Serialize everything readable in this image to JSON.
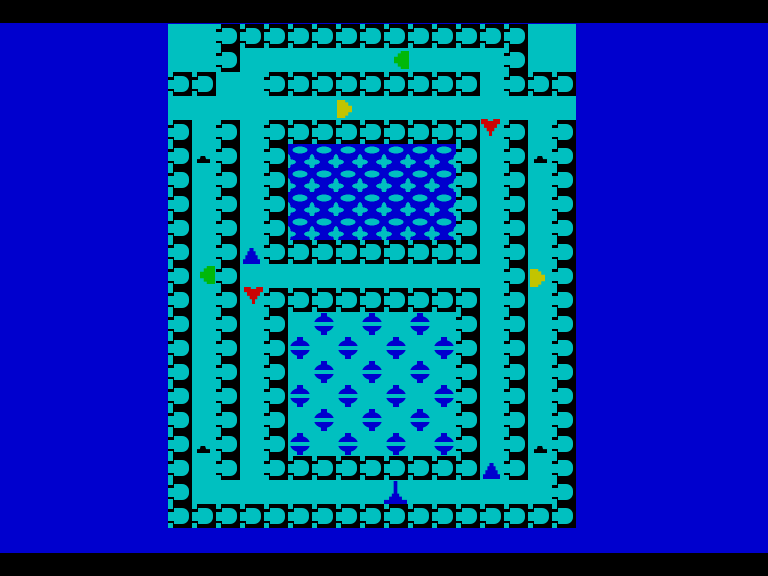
{
  "screen": {
    "width": 768,
    "height": 576
  },
  "colors": {
    "blue": "#0000CE",
    "cyan": "#00C0C0",
    "black": "#000000",
    "green": "#00B80A",
    "yellow": "#C2C400",
    "red": "#CC0404"
  },
  "letterbox": {
    "top_height": 23,
    "bottom_height": 23,
    "bottom_top": 553
  },
  "board": {
    "origin_x": 168,
    "origin_y": 24,
    "cell": 24,
    "cols": 17,
    "rows": 21,
    "first_col": 7,
    "first_row": 1,
    "legend": {
      "#": "wall-block",
      ".": "open-corridor",
      "w": "water",
      "o": "orchard"
    },
    "rows_map": [
      "..#############..",
      "..#...........#..",
      "##..#########.###",
      ".................",
      "#.#.#########.#.#",
      "#.#.#wwwwwww#.#.#",
      "#.#.#wwwwwww#.#.#",
      "#.#.#wwwwwww#.#.#",
      "#.#.#wwwwwww#.#.#",
      "#.#.#########.#.#",
      "#.#...........#.#",
      "#.#.#########.#.#",
      "#.#.#ooooooo#.#.#",
      "#.#.#ooooooo#.#.#",
      "#.#.#ooooooo#.#.#",
      "#.#.#ooooooo#.#.#",
      "#.#.#ooooooo#.#.#",
      "#.#.#ooooooo#.#.#",
      "#.#.#########.#.#",
      "#...............#",
      "#################"
    ]
  },
  "water_area": {
    "col": 12,
    "row": 6,
    "cols": 7,
    "rows": 4
  },
  "orbs": {
    "positions": [
      [
        13,
        13
      ],
      [
        15,
        13
      ],
      [
        17,
        13
      ],
      [
        12,
        14
      ],
      [
        14,
        14
      ],
      [
        16,
        14
      ],
      [
        18,
        14
      ],
      [
        13,
        15
      ],
      [
        15,
        15
      ],
      [
        17,
        15
      ],
      [
        12,
        16
      ],
      [
        14,
        16
      ],
      [
        16,
        16
      ],
      [
        18,
        16
      ],
      [
        13,
        17
      ],
      [
        15,
        17
      ],
      [
        17,
        17
      ],
      [
        12,
        18
      ],
      [
        14,
        18
      ],
      [
        16,
        18
      ],
      [
        18,
        18
      ]
    ]
  },
  "items": [
    {
      "id": "item-green-1",
      "type": "green",
      "x": 394,
      "y": 51
    },
    {
      "id": "item-yellow-1",
      "type": "yellow",
      "x": 337,
      "y": 100
    },
    {
      "id": "item-red-1",
      "type": "red",
      "x": 481,
      "y": 119
    },
    {
      "id": "item-blue-1",
      "type": "blue",
      "x": 243,
      "y": 248
    },
    {
      "id": "item-green-2",
      "type": "green",
      "x": 200,
      "y": 266
    },
    {
      "id": "item-red-2",
      "type": "red",
      "x": 244,
      "y": 287
    },
    {
      "id": "item-yellow-2",
      "type": "yellow",
      "x": 530,
      "y": 269
    },
    {
      "id": "item-blue-2",
      "type": "blue",
      "x": 483,
      "y": 463
    }
  ],
  "player": {
    "x": 384,
    "y": 481
  },
  "marks": [
    {
      "x": 197,
      "y": 156
    },
    {
      "x": 534,
      "y": 156
    },
    {
      "x": 197,
      "y": 446
    },
    {
      "x": 534,
      "y": 446
    }
  ]
}
